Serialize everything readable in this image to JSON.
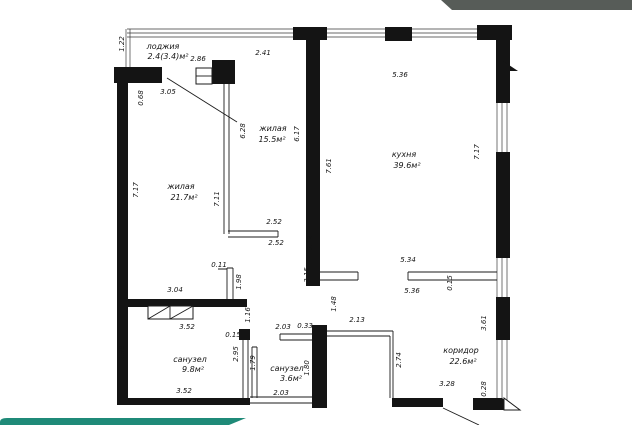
{
  "decor": {
    "top_band_color": "#575c58",
    "accent_color": "#1f8a78"
  },
  "plan": {
    "rooms": [
      {
        "name": "лоджия",
        "area": "2.4(3.4)м²",
        "nx": 163,
        "ny": 49,
        "ax": 168,
        "ay": 59
      },
      {
        "name": "жилая",
        "area": "15.5м²",
        "nx": 273,
        "ny": 131,
        "ax": 272,
        "ay": 142
      },
      {
        "name": "жилая",
        "area": "21.7м²",
        "nx": 181,
        "ny": 189,
        "ax": 184,
        "ay": 200
      },
      {
        "name": "кухня",
        "area": "39.6м²",
        "nx": 404,
        "ny": 157,
        "ax": 407,
        "ay": 168
      },
      {
        "name": "санузел",
        "area": "9.8м²",
        "nx": 190,
        "ny": 362,
        "ax": 193,
        "ay": 372
      },
      {
        "name": "санузел",
        "area": "3.6м²",
        "nx": 287,
        "ny": 371,
        "ax": 291,
        "ay": 381
      },
      {
        "name": "коридор",
        "area": "22.6м²",
        "nx": 461,
        "ny": 353,
        "ax": 463,
        "ay": 364
      }
    ],
    "dimensions": [
      {
        "value": "1.22",
        "x": 124,
        "y": 44,
        "rot": 1
      },
      {
        "value": "2.86",
        "x": 198,
        "y": 61,
        "rot": 0
      },
      {
        "value": "2.41",
        "x": 263,
        "y": 55,
        "rot": 0
      },
      {
        "value": "3.05",
        "x": 168,
        "y": 94,
        "rot": 0
      },
      {
        "value": "0.68",
        "x": 143,
        "y": 98,
        "rot": 1
      },
      {
        "value": "5.36",
        "x": 400,
        "y": 77,
        "rot": 0
      },
      {
        "value": "6.28",
        "x": 245,
        "y": 131,
        "rot": 1
      },
      {
        "value": "6.17",
        "x": 299,
        "y": 134,
        "rot": 1
      },
      {
        "value": "7.61",
        "x": 331,
        "y": 166,
        "rot": 1
      },
      {
        "value": "7.17",
        "x": 138,
        "y": 190,
        "rot": 1
      },
      {
        "value": "7.11",
        "x": 219,
        "y": 199,
        "rot": 1
      },
      {
        "value": "7.17",
        "x": 479,
        "y": 152,
        "rot": 1
      },
      {
        "value": "2.52",
        "x": 274,
        "y": 224,
        "rot": 0
      },
      {
        "value": "2.52",
        "x": 276,
        "y": 245,
        "rot": 0
      },
      {
        "value": "0.12",
        "x": 312,
        "y": 243,
        "rot": 1
      },
      {
        "value": "3.15",
        "x": 309,
        "y": 275,
        "rot": 1
      },
      {
        "value": "1.48",
        "x": 336,
        "y": 304,
        "rot": 1
      },
      {
        "value": "5.34",
        "x": 408,
        "y": 262,
        "rot": 0
      },
      {
        "value": "5.36",
        "x": 412,
        "y": 293,
        "rot": 0
      },
      {
        "value": "0.15",
        "x": 452,
        "y": 283,
        "rot": 1
      },
      {
        "value": "0.11",
        "x": 219,
        "y": 267,
        "rot": 0
      },
      {
        "value": "1.98",
        "x": 241,
        "y": 282,
        "rot": 1
      },
      {
        "value": "3.04",
        "x": 175,
        "y": 292,
        "rot": 0
      },
      {
        "value": "3.52",
        "x": 187,
        "y": 329,
        "rot": 0
      },
      {
        "value": "3.52",
        "x": 184,
        "y": 393,
        "rot": 0
      },
      {
        "value": "2.98",
        "x": 124,
        "y": 353,
        "rot": 1
      },
      {
        "value": "1.16",
        "x": 250,
        "y": 315,
        "rot": 1
      },
      {
        "value": "0.15",
        "x": 233,
        "y": 337,
        "rot": 0
      },
      {
        "value": "2.95",
        "x": 238,
        "y": 354,
        "rot": 1
      },
      {
        "value": "1.79",
        "x": 255,
        "y": 363,
        "rot": 1
      },
      {
        "value": "2.03",
        "x": 283,
        "y": 329,
        "rot": 0
      },
      {
        "value": "0.33",
        "x": 305,
        "y": 328,
        "rot": 0
      },
      {
        "value": "2.03",
        "x": 281,
        "y": 395,
        "rot": 0
      },
      {
        "value": "1.80",
        "x": 309,
        "y": 368,
        "rot": 1
      },
      {
        "value": "2.13",
        "x": 357,
        "y": 322,
        "rot": 0
      },
      {
        "value": "2.74",
        "x": 401,
        "y": 360,
        "rot": 1
      },
      {
        "value": "3.28",
        "x": 447,
        "y": 386,
        "rot": 0
      },
      {
        "value": "0.28",
        "x": 486,
        "y": 389,
        "rot": 1
      },
      {
        "value": "3.61",
        "x": 486,
        "y": 323,
        "rot": 1
      }
    ]
  }
}
